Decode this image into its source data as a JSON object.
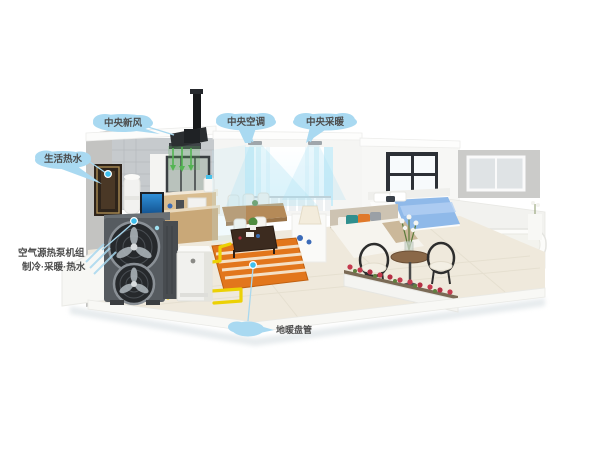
{
  "scene": {
    "description": "3D cutaway house showing an air-source heat pump whole-home comfort system",
    "background": "#ffffff"
  },
  "callouts": {
    "fresh_air": "中央新风",
    "hot_water": "生活热水",
    "central_ac": "中央空调",
    "central_heating": "中央采暖",
    "heat_pump_line1": "空气源热泵机组",
    "heat_pump_line2": "制冷·采暖·热水",
    "floor_heating": "地暖盘管"
  },
  "colors": {
    "callout_bubble": "#a9d9f1",
    "callout_text": "#4d4d4d",
    "leader_line": "#a8d8ef",
    "anchor_dot": "#3fc0ee",
    "heat_pump_body": "#565b60",
    "water_tank": "#f1f1ee",
    "pipe_yellow": "#ecd104",
    "floor_heating_rug": "#e2761c",
    "airflow_green": "#53b552",
    "airflow_cyan": "#bfe8f5",
    "bed_blue": "#8fb9e9",
    "flower_red": "#c43a4e"
  }
}
